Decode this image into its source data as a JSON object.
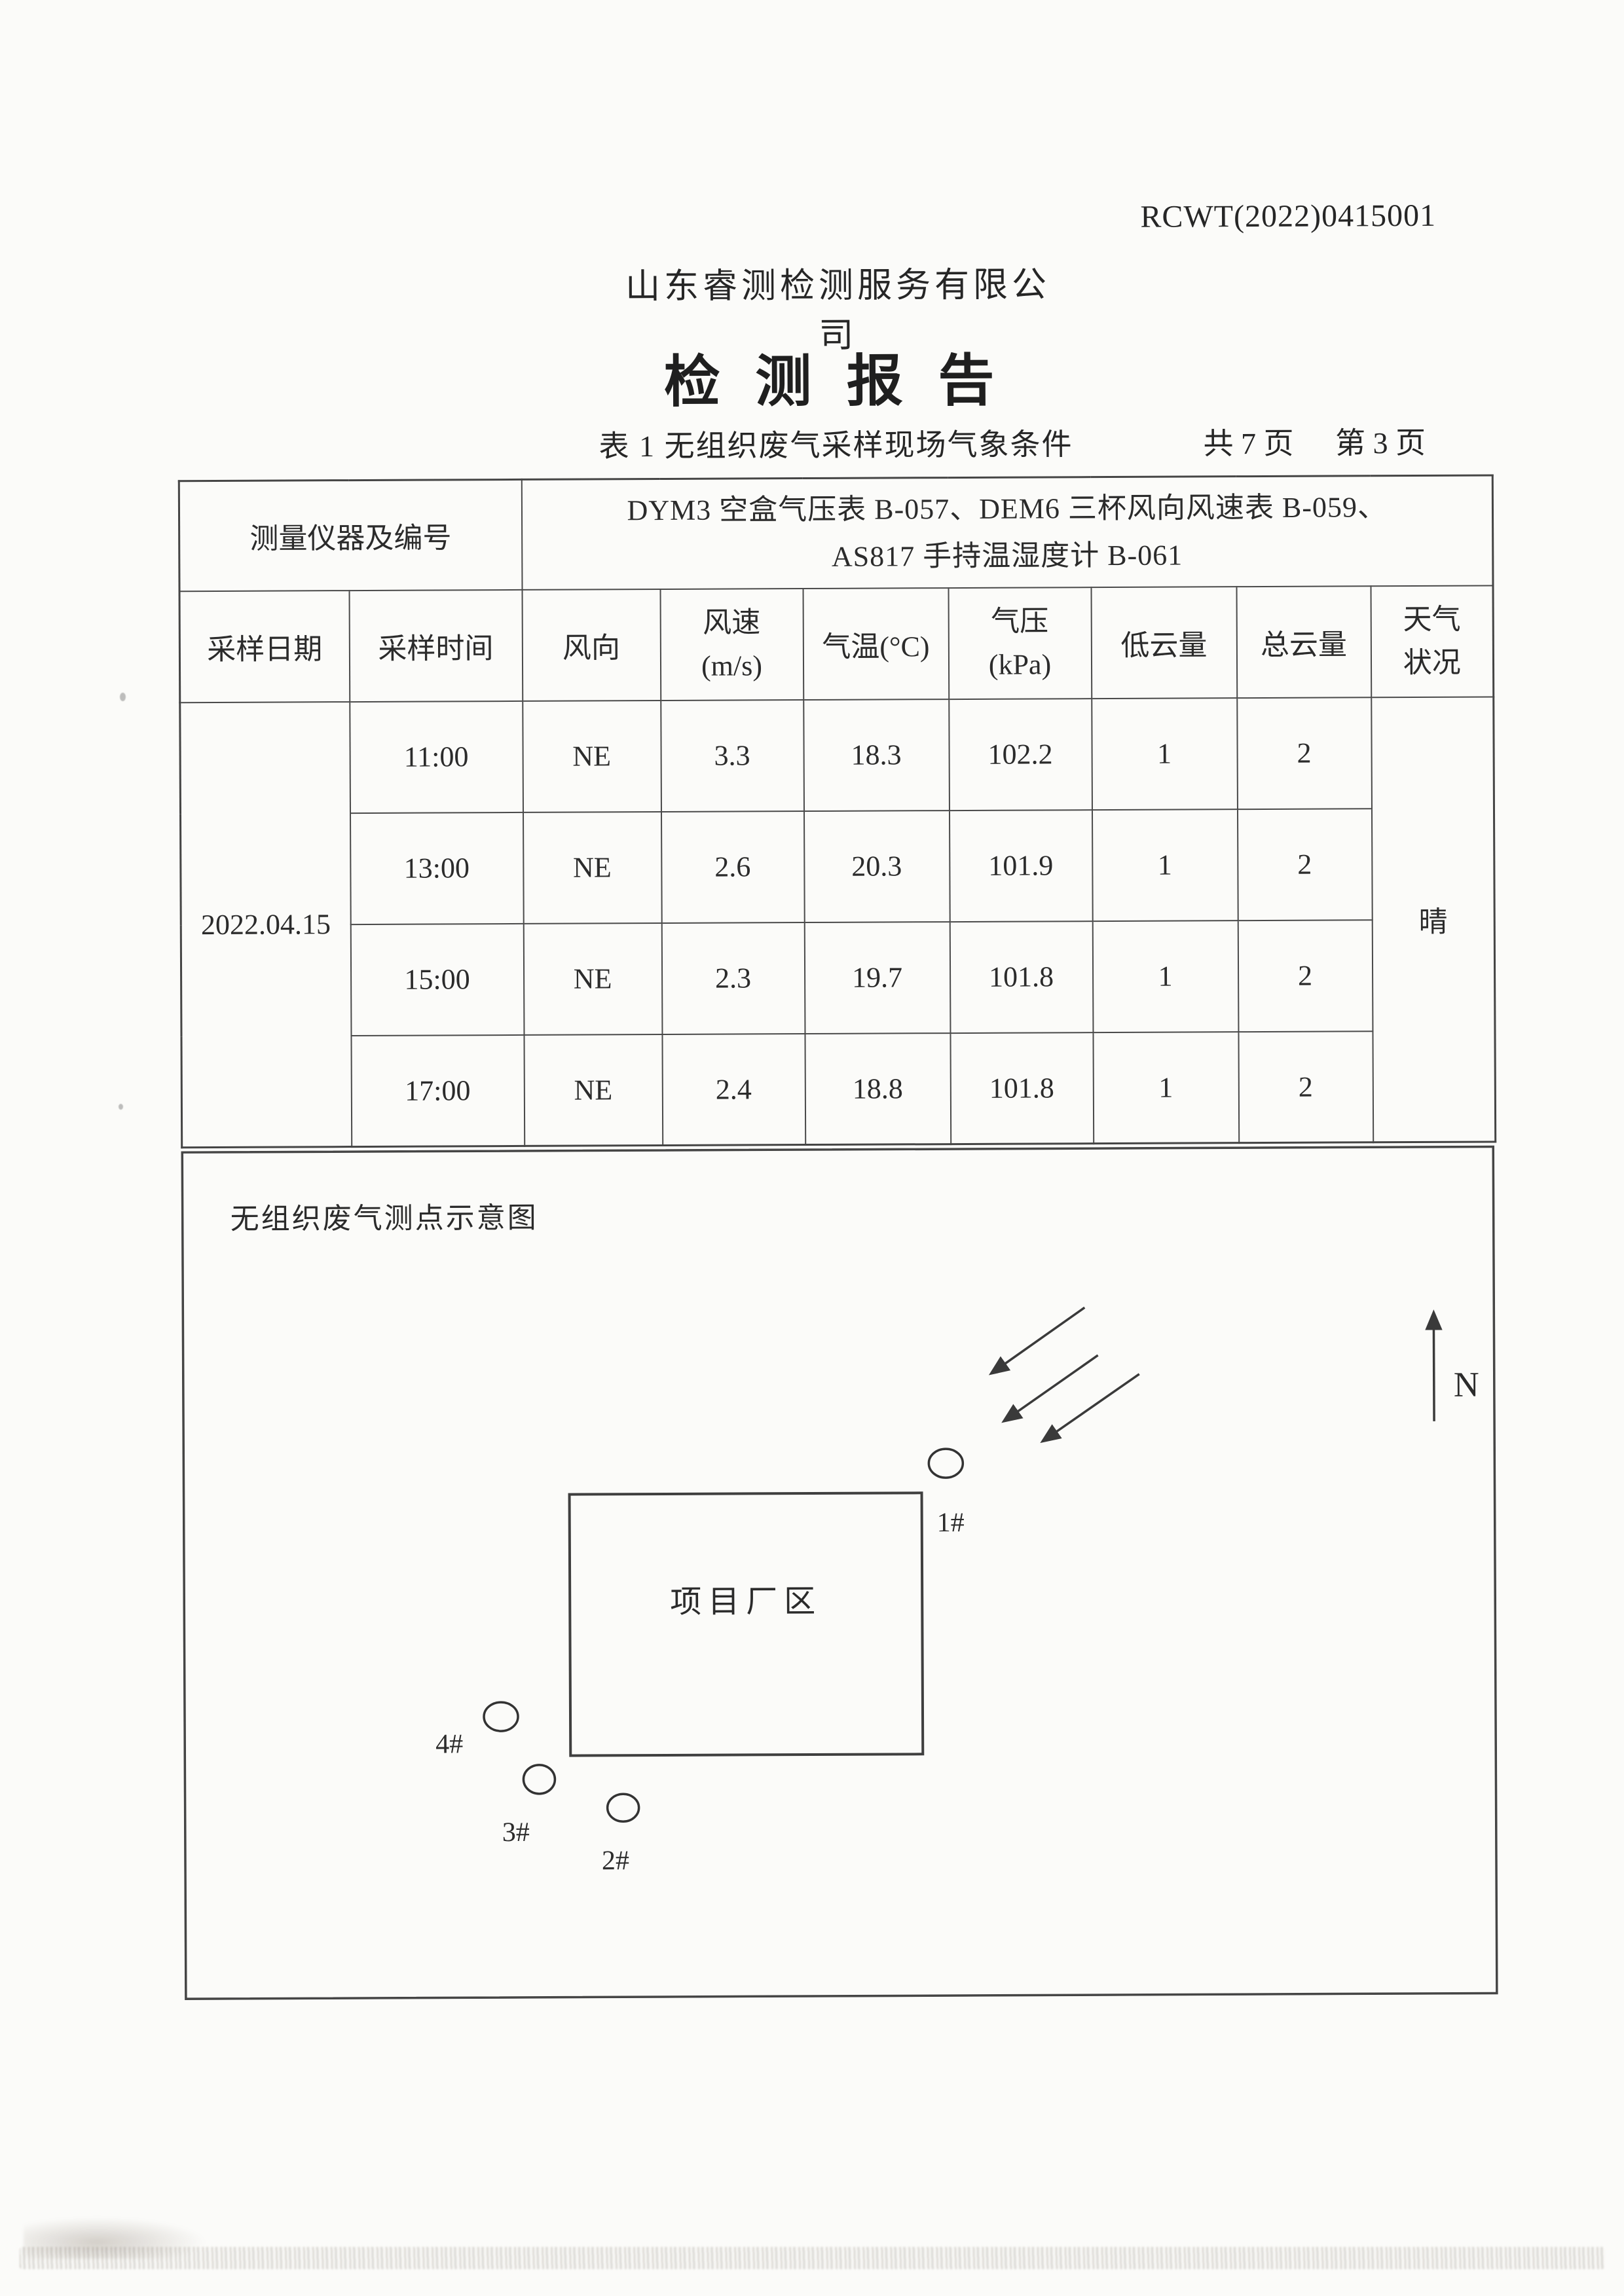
{
  "page": {
    "report_number": "RCWT(2022)0415001",
    "company_name": "山东睿测检测服务有限公司",
    "report_title": "检 测 报 告",
    "table_caption": "表 1  无组织废气采样现场气象条件",
    "pages_total": "共 7 页",
    "page_current": "第 3 页"
  },
  "table": {
    "instrument_label": "测量仪器及编号",
    "instrument_line1": "DYM3 空盒气压表 B-057、DEM6 三杯风向风速表 B-059、",
    "instrument_line2": "AS817 手持温湿度计 B-061",
    "headers": [
      {
        "l1": "采样日期"
      },
      {
        "l1": "采样时间"
      },
      {
        "l1": "风向"
      },
      {
        "l1": "风速",
        "l2": "(m/s)"
      },
      {
        "l1": "气温(°C)"
      },
      {
        "l1": "气压",
        "l2": "(kPa)"
      },
      {
        "l1": "低云量"
      },
      {
        "l1": "总云量"
      },
      {
        "l1": "天气",
        "l2": "状况"
      }
    ],
    "sampling_date": "2022.04.15",
    "weather": "晴",
    "rows": [
      {
        "time": "11:00",
        "wind_direction": "NE",
        "wind_speed": "3.3",
        "temperature": "18.3",
        "pressure": "102.2",
        "low_cloud": "1",
        "total_cloud": "2"
      },
      {
        "time": "13:00",
        "wind_direction": "NE",
        "wind_speed": "2.6",
        "temperature": "20.3",
        "pressure": "101.9",
        "low_cloud": "1",
        "total_cloud": "2"
      },
      {
        "time": "15:00",
        "wind_direction": "NE",
        "wind_speed": "2.3",
        "temperature": "19.7",
        "pressure": "101.8",
        "low_cloud": "1",
        "total_cloud": "2"
      },
      {
        "time": "17:00",
        "wind_direction": "NE",
        "wind_speed": "2.4",
        "temperature": "18.8",
        "pressure": "101.8",
        "low_cloud": "1",
        "total_cloud": "2"
      }
    ]
  },
  "diagram": {
    "title": "无组织废气测点示意图",
    "site_label": "项目厂区",
    "north_label": "N",
    "points": [
      {
        "label": "1#"
      },
      {
        "label": "2#"
      },
      {
        "label": "3#"
      },
      {
        "label": "4#"
      }
    ]
  }
}
